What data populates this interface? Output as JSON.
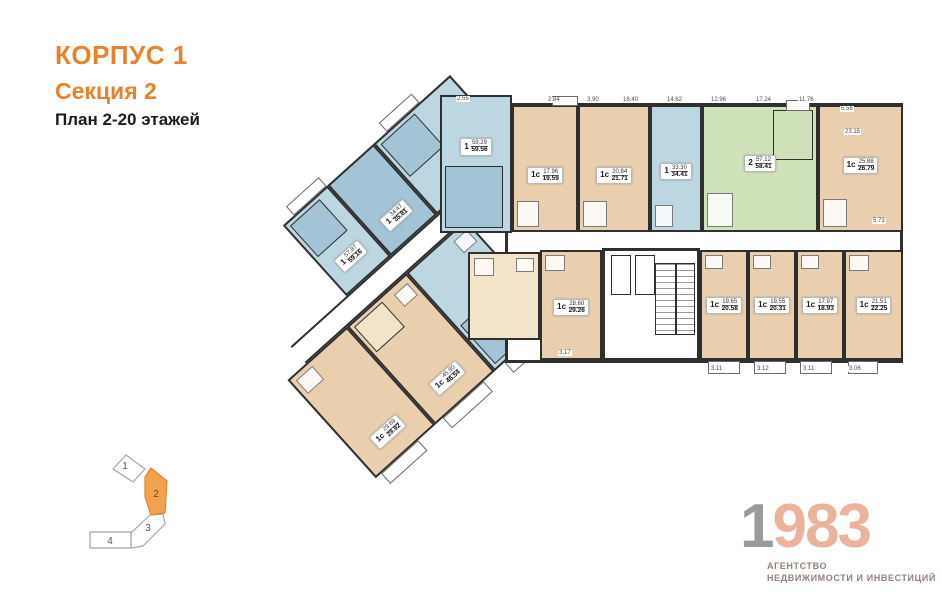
{
  "header": {
    "building": "КОРПУС 1",
    "section": "Секция 2",
    "floors": "План 2-20 этажей"
  },
  "colors": {
    "accent_orange": "#E8832A",
    "apartment_blue": "#bcd6e2",
    "apartment_blue_dark": "#a2c4d6",
    "apartment_beige": "#eacfae",
    "apartment_green": "#cfe2ba",
    "wall": "#2f2f2f",
    "keyplan_active": "#F2A24E",
    "logo_gray": "#9a9a9a",
    "logo_salmon": "#e9b39c"
  },
  "plan": {
    "apartments": [
      {
        "type": "1",
        "area": "59.29",
        "total": "59.56",
        "color": "blue"
      },
      {
        "type": "1с",
        "area": "17.96",
        "total": "19.59",
        "color": "beige"
      },
      {
        "type": "1с",
        "area": "20.84",
        "total": "21.71",
        "color": "beige"
      },
      {
        "type": "1",
        "area": "33.30",
        "total": "34.41",
        "color": "blue"
      },
      {
        "type": "2",
        "area": "57.12",
        "total": "58.41",
        "color": "green"
      },
      {
        "type": "1с",
        "area": "25.88",
        "total": "26.79",
        "color": "beige"
      },
      {
        "type": "1с",
        "area": "28.60",
        "total": "29.26",
        "color": "beige"
      },
      {
        "type": "1с",
        "area": "19.65",
        "total": "20.58",
        "color": "beige"
      },
      {
        "type": "1с",
        "area": "19.55",
        "total": "20.31",
        "color": "beige"
      },
      {
        "type": "1с",
        "area": "17.97",
        "total": "18.93",
        "color": "beige"
      },
      {
        "type": "1с",
        "area": "21.51",
        "total": "22.25",
        "color": "beige"
      },
      {
        "type": "1",
        "area": "57.87",
        "total": "59.16",
        "color": "blue"
      },
      {
        "type": "1",
        "area": "34.47",
        "total": "35.81",
        "color": "blue"
      },
      {
        "type": "1",
        "area": "65.02",
        "total": "65.56",
        "color": "blue"
      },
      {
        "type": "1с",
        "area": "29.69",
        "total": "29.92",
        "color": "beige"
      },
      {
        "type": "1с",
        "area": "45.80",
        "total": "46.54",
        "color": "beige"
      },
      {
        "type": "1",
        "area": "36.18",
        "total": "37.20",
        "color": "blue"
      }
    ],
    "dimensions": [
      {
        "v": "2.55",
        "x": 456,
        "y": 96
      },
      {
        "v": "2.84",
        "x": 547,
        "y": 97
      },
      {
        "v": "3.90",
        "x": 586,
        "y": 97
      },
      {
        "v": "16.40",
        "x": 622,
        "y": 97
      },
      {
        "v": "14.62",
        "x": 666,
        "y": 97
      },
      {
        "v": "12.96",
        "x": 710,
        "y": 97
      },
      {
        "v": "17.24",
        "x": 755,
        "y": 97
      },
      {
        "v": "11.76",
        "x": 798,
        "y": 97
      },
      {
        "v": "5.56",
        "x": 840,
        "y": 106
      },
      {
        "v": "23.15",
        "x": 844,
        "y": 129
      },
      {
        "v": "5.73",
        "x": 872,
        "y": 218
      },
      {
        "v": "3.17",
        "x": 558,
        "y": 350
      },
      {
        "v": "3.11",
        "x": 710,
        "y": 366
      },
      {
        "v": "3.12",
        "x": 756,
        "y": 366
      },
      {
        "v": "3.11",
        "x": 802,
        "y": 366
      },
      {
        "v": "3.06",
        "x": 848,
        "y": 366
      }
    ]
  },
  "keyplan": {
    "sections": [
      {
        "label": "1",
        "active": false
      },
      {
        "label": "2",
        "active": true
      },
      {
        "label": "3",
        "active": false
      },
      {
        "label": "4",
        "active": false
      }
    ]
  },
  "logo": {
    "digit1": "1",
    "digits": "983",
    "line1": "АГЕНТСТВО",
    "line2": "НЕДВИЖИМОСТИ И ИНВЕСТИЦИЙ"
  }
}
